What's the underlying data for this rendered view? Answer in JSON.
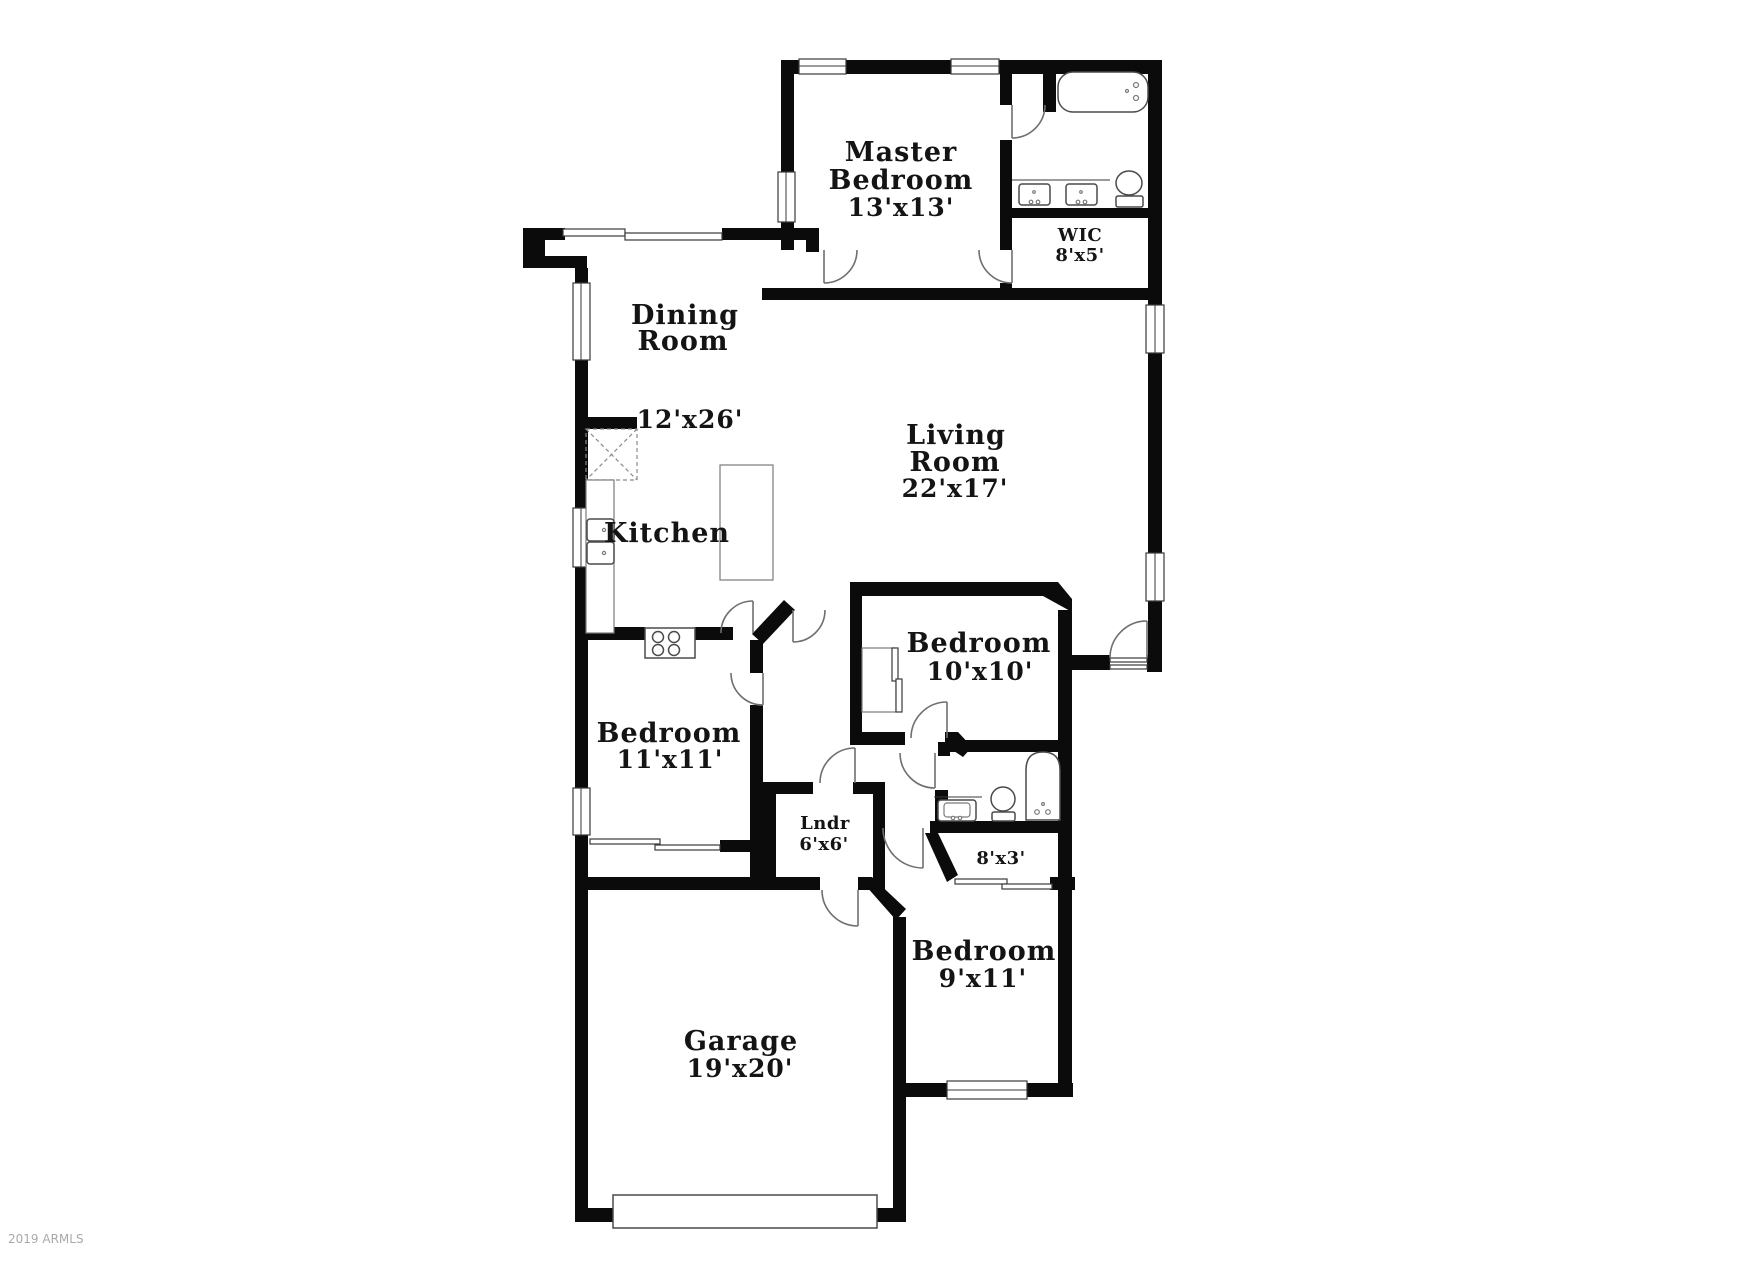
{
  "watermark": "2019 ARMLS",
  "rooms": {
    "master": {
      "line1": "Master",
      "line2": "Bedroom",
      "dims": "13'x13'"
    },
    "wic": {
      "name": "WIC",
      "dims": "8'x5'"
    },
    "dining": {
      "line1": "Dining",
      "line2": "Room",
      "dims": "12'x26'"
    },
    "living": {
      "line1": "Living",
      "line2": "Room",
      "dims": "22'x17'"
    },
    "kitchen": {
      "name": "Kitchen"
    },
    "bedroom10": {
      "name": "Bedroom",
      "dims": "10'x10'"
    },
    "bedroom11": {
      "name": "Bedroom",
      "dims": "11'x11'"
    },
    "laundry": {
      "name": "Lndr",
      "dims": "6'x6'"
    },
    "closet": {
      "dims": "8'x3'"
    },
    "bedroom9": {
      "name": "Bedroom",
      "dims": "9'x11'"
    },
    "garage": {
      "name": "Garage",
      "dims": "19'x20'"
    }
  },
  "colors": {
    "wall": "#0b0b0b",
    "fixture_line": "#4a4a4a",
    "door_arc": "#6f6f6f",
    "label": "#141414",
    "watermark": "#a9a9a9",
    "background": "#ffffff"
  }
}
